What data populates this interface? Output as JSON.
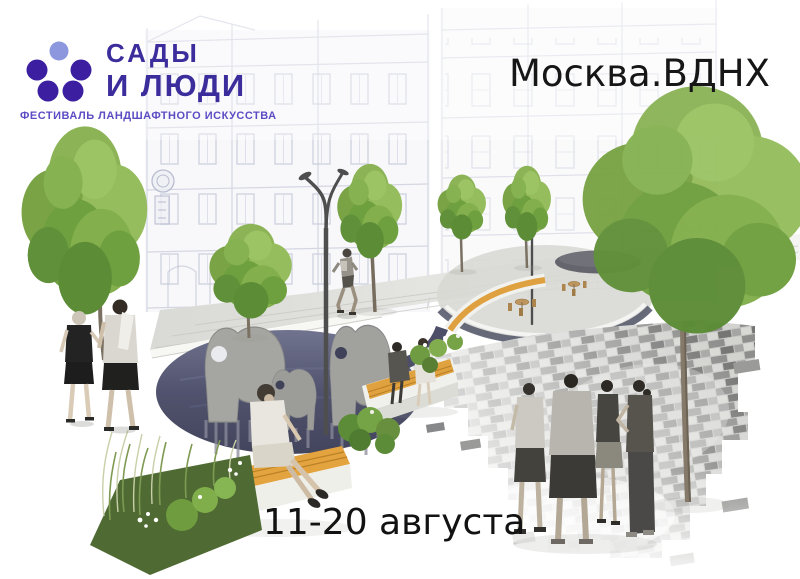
{
  "brand": {
    "icon": "five-dots-logo-icon",
    "title_line1": "САДЫ",
    "title_line2": "И ЛЮДИ",
    "tagline": "ФЕСТИВАЛЬ ЛАНДШАФТНОГО ИСКУССТВА",
    "colors": {
      "primary": "#3c2d9c",
      "dot_dark": "#3b1fa0",
      "dot_light": "#8d97dd",
      "tagline": "#5c4cc4"
    }
  },
  "event": {
    "location": "Москва.ВДНХ",
    "dates": "11-20 августа",
    "text_color": "#141414"
  },
  "scene": {
    "description": "Landscape-architecture rendering: sketched historic facades, pedestrian plaza with trees and curved street lamps, dark pond with flat elephant sculptures, wooden benches, planting beds and people",
    "palette": {
      "foliage": "#7fa848",
      "bench_wood": "#e2a13c",
      "pond": "#45476a",
      "paving_light": "#dededb",
      "paving_dark": "#8e8f8d",
      "sketch_line": "#c6c9d9"
    }
  }
}
